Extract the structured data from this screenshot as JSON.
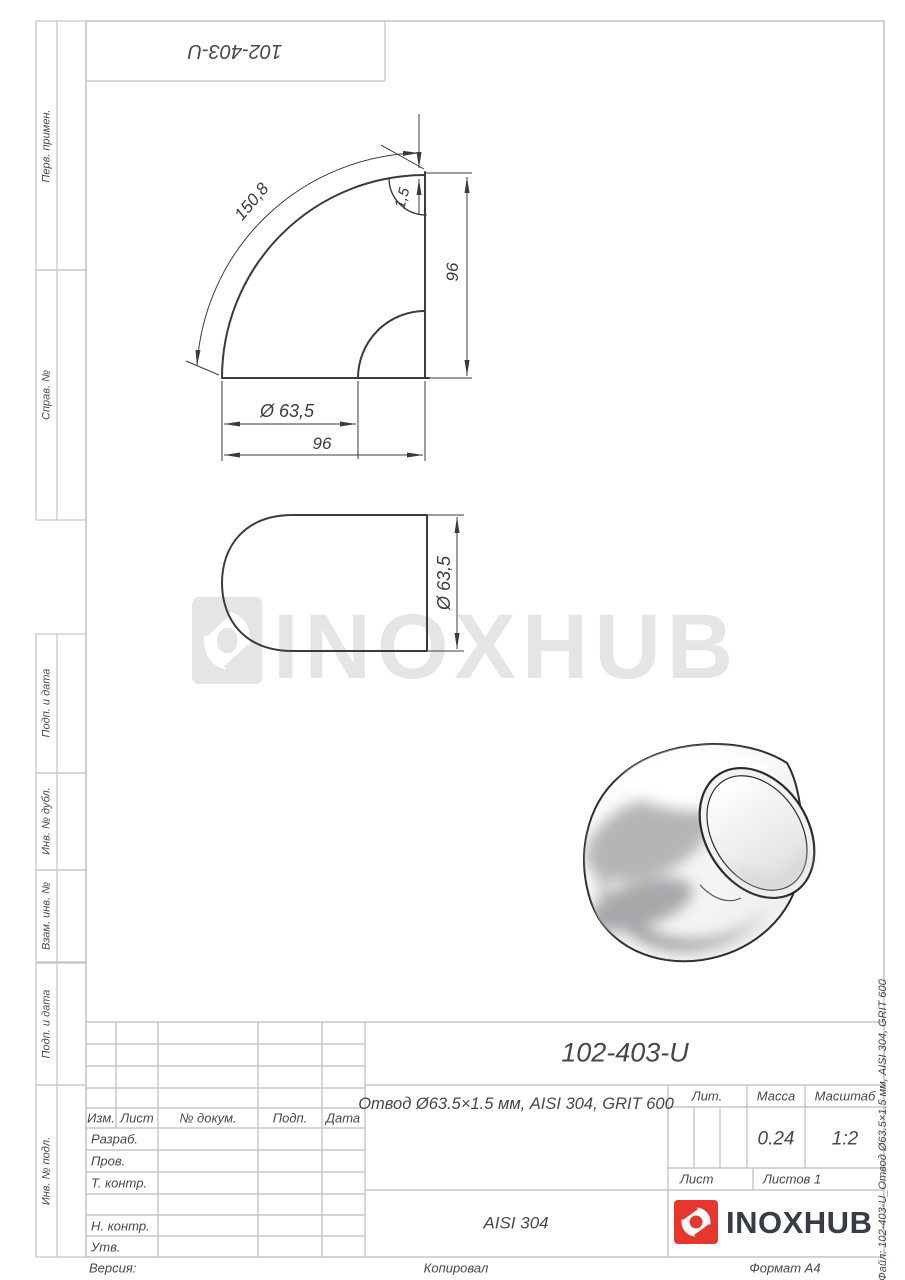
{
  "sheet": {
    "top_stamp": "102-403-U",
    "side_file_label": "Файл: 102-403-U_Отвод Ø63.5×1.5 мм, AISI 304, GRIT 600",
    "footer": {
      "version": "Версия:",
      "copied": "Копировал",
      "format": "Формат А4"
    }
  },
  "margin": {
    "labels": [
      "Перв. примен.",
      "Справ. №",
      "Подп. и дата",
      "Инв. № дубл.",
      "Взам. инв. №",
      "Подп. и дата",
      "Инв. № подл."
    ]
  },
  "drawing": {
    "dims": {
      "arc_length": "150,8",
      "wall_thickness": "1,5",
      "height": "96",
      "diameter": "Ø 63,5",
      "width": "96",
      "side_diameter": "Ø 63,5"
    }
  },
  "watermark": {
    "text": "INOXHUB"
  },
  "title_block": {
    "change_header": [
      "Изм.",
      "Лист",
      "№ докум.",
      "Подп.",
      "Дата"
    ],
    "sign_rows": [
      "Разраб.",
      "Пров.",
      "Т. контр.",
      "Н. контр.",
      "Утв."
    ],
    "doc_number": "102-403-U",
    "description": "Отвод Ø63.5×1.5 мм, AISI 304, GRIT 600",
    "material": "AISI 304",
    "lit_label": "Лит.",
    "mass_label": "Масса",
    "scale_label": "Масштаб",
    "mass_value": "0.24",
    "scale_value": "1:2",
    "sheet_label": "Лист",
    "sheets_label": "Листов 1",
    "brand": "INOXHUB"
  }
}
